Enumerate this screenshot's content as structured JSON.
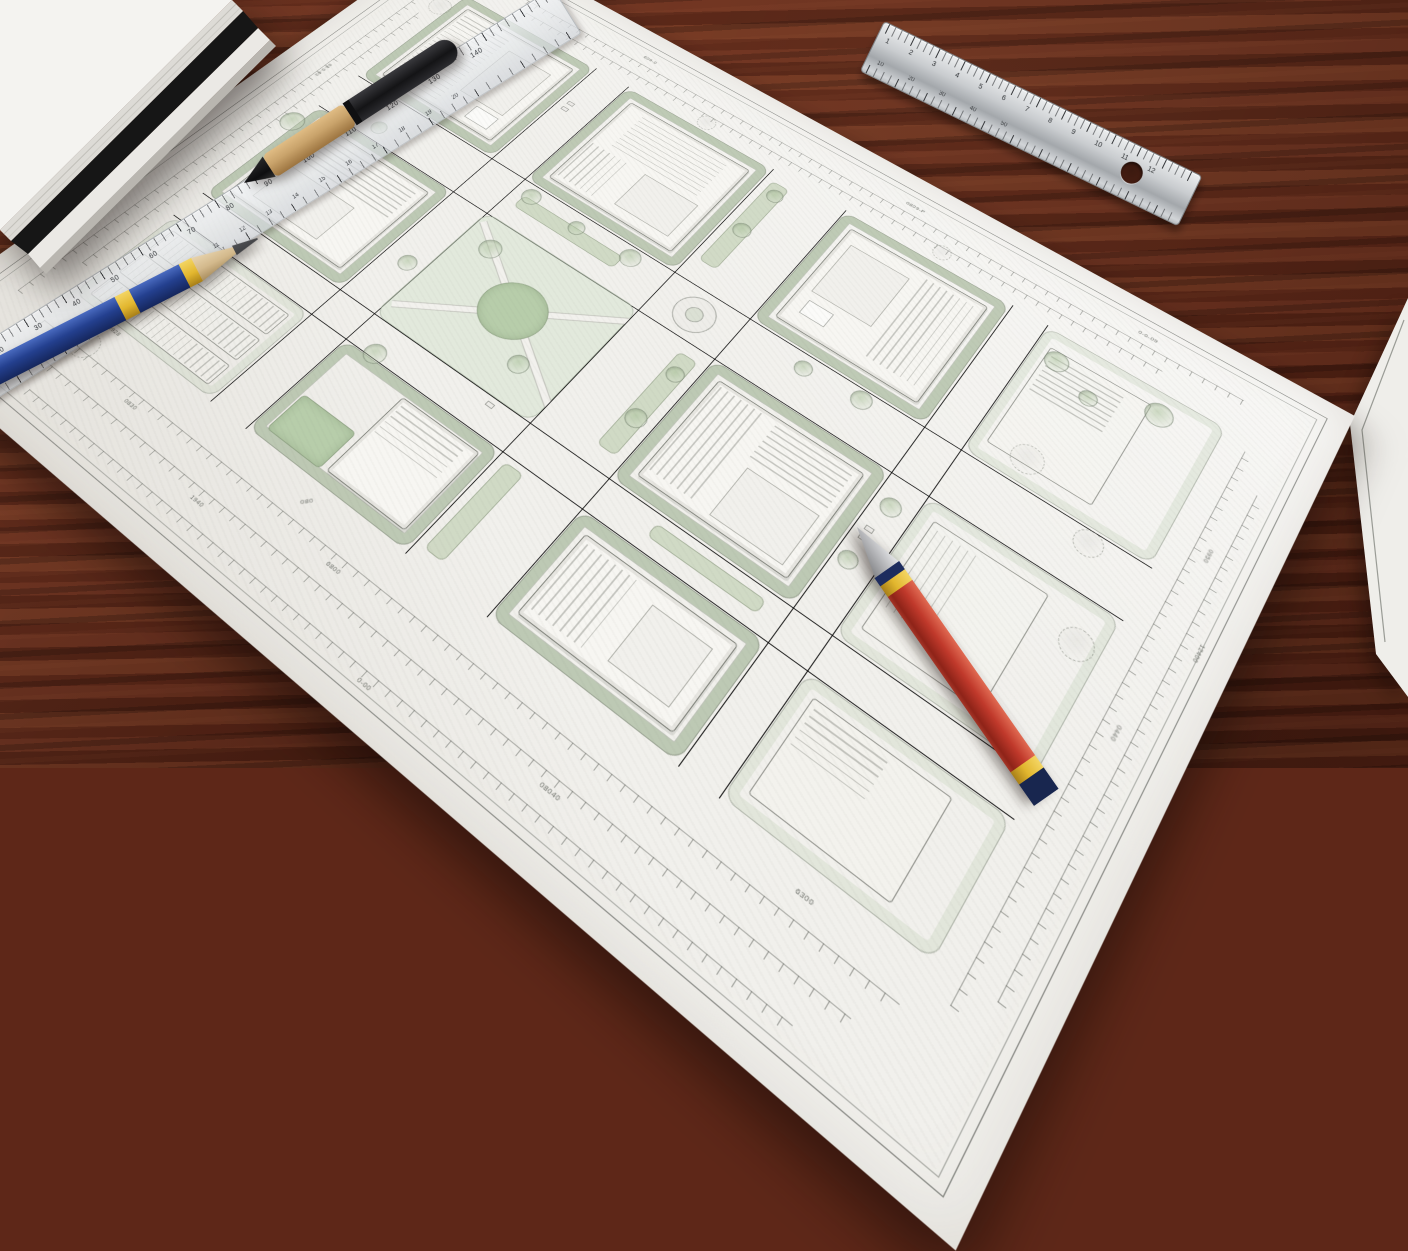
{
  "palette": {
    "desk_wood": "#5e2718",
    "paper": "#f1f0ec",
    "plan_line": "#73766e",
    "plan_green": "#cfdec6",
    "lawn_green": "#b7cdaa",
    "pencil_blue": "#24408f",
    "pencil_red": "#c0392b",
    "band_yellow": "#e2b62e",
    "pen_tan": "#c9a36b",
    "pen_black": "#141416",
    "steel_ruler": "#c9cccf"
  },
  "sheet": {
    "top_labels": [
      "609-0",
      "0809-P",
      "0-0-09"
    ],
    "dim_labels": [
      "0830",
      "6800",
      "08040",
      "1940",
      "0950",
      "0440",
      "12400",
      "63-5-63",
      "0928",
      "0-00",
      "6300",
      "080"
    ]
  },
  "rulers": {
    "acrylic_numbers": "10 20 30 40 50 60 70 80 90 100 110 120 130 140",
    "acrylic_fine": "1 2 3 4 5 6 7 8 9 10 11 12 13 14 15 16 17 18 19 20",
    "steel_numbers": "1 2 3 4 5 6 7 8 9 10 11 12",
    "steel_fine": "10 20 30 40 50"
  }
}
